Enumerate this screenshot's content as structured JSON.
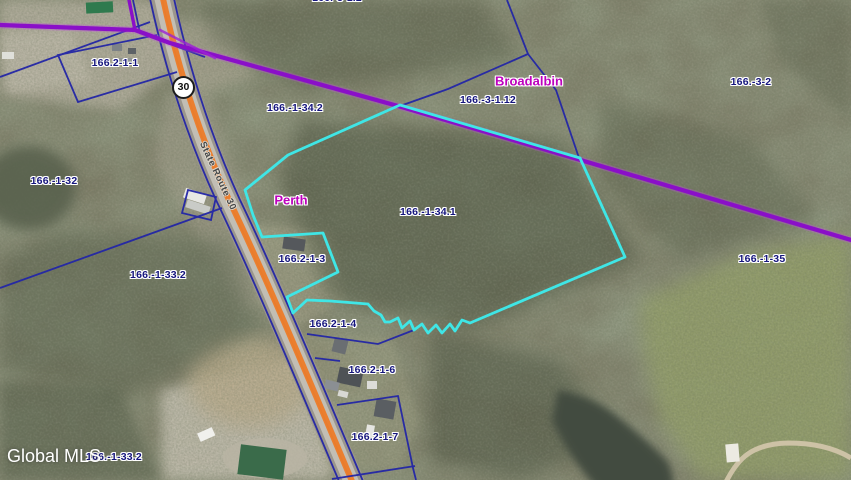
{
  "map": {
    "watermark": "Global MLS",
    "road": {
      "shield": "30",
      "name": "State Route 30"
    },
    "towns": [
      {
        "name": "Perth"
      },
      {
        "name": "Broadalbin"
      }
    ],
    "parcel_labels": [
      {
        "id": "166.2-1-1"
      },
      {
        "id": "166.-1-32"
      },
      {
        "id": "166.-1-33.2"
      },
      {
        "id": "166.-1-34.2"
      },
      {
        "id": "166.-3-1.12"
      },
      {
        "id": "166.-3-2"
      },
      {
        "id": "166.-1-35"
      },
      {
        "id": "166.-1-34.1"
      },
      {
        "id": "166.2-1-3"
      },
      {
        "id": "166.2-1-4"
      },
      {
        "id": "166.2-1-6"
      },
      {
        "id": "166.2-1-7"
      },
      {
        "id": "166.-1-33.2"
      },
      {
        "id": "166.-3-1.2"
      }
    ],
    "colors": {
      "highlight_parcel": "#3fe6e6",
      "municipal_boundary": "#8a0fc8",
      "parcel_lines": "#2326a6",
      "route_stripe": "#ed7b28",
      "town_text": "#bd00bd",
      "parcel_text": "#15157d"
    }
  }
}
